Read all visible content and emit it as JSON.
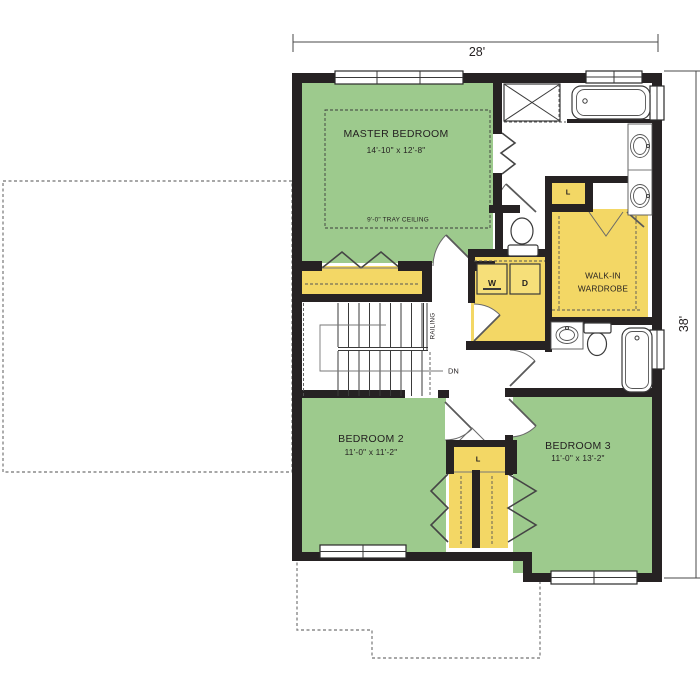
{
  "dimensions": {
    "width_label": "28'",
    "height_label": "38'"
  },
  "rooms": {
    "master_bedroom": {
      "name": "MASTER BEDROOM",
      "size": "14'-10\" x 12'-8\"",
      "ceiling_note": "9'-0\" TRAY CEILING"
    },
    "walk_in_wardrobe": {
      "name_line1": "WALK-IN",
      "name_line2": "WARDROBE"
    },
    "bedroom_2": {
      "name": "BEDROOM 2",
      "size": "11'-0\" x 11'-2\""
    },
    "bedroom_3": {
      "name": "BEDROOM 3",
      "size": "11'-0\" x 13'-2\""
    }
  },
  "labels": {
    "washer": "W",
    "dryer": "D",
    "linen_upper": "L",
    "linen_lower": "L",
    "stairs_down": "DN",
    "railing": "RAILING"
  },
  "colors": {
    "room_fill_green": "#9dca8d",
    "closet_fill_yellow": "#f3d765",
    "wall_black": "#262223",
    "dimension_gray": "#4a4a4a"
  }
}
